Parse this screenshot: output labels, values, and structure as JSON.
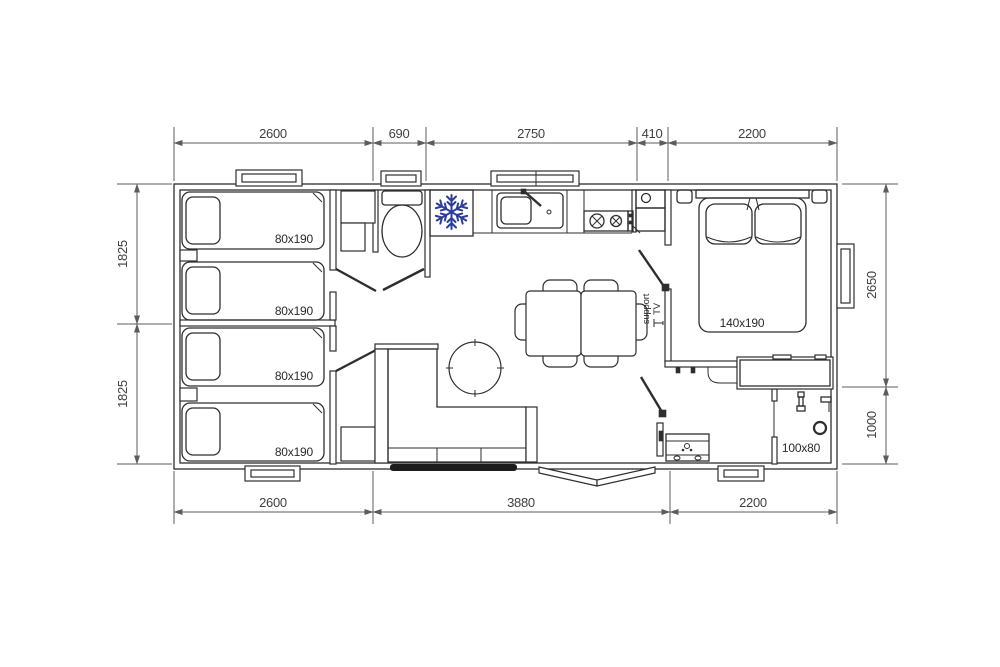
{
  "document": {
    "type": "floor-plan",
    "subject": "mobile home layout with three bedrooms, bathroom, kitchen and living room"
  },
  "colors": {
    "background": "#ffffff",
    "line": "#2e2e2e",
    "dimension_line": "#5c5c5c",
    "snowflake": "#2e3d9b",
    "dark_window": "#1c1c1c"
  },
  "dimensions": {
    "top": [
      "2600",
      "690",
      "2750",
      "410",
      "2200"
    ],
    "bottom": [
      "2600",
      "3880",
      "2200"
    ],
    "left": [
      "1825",
      "1825"
    ],
    "right": [
      "2650",
      "1000"
    ]
  },
  "labels": {
    "bed1": "80x190",
    "bed2": "80x190",
    "bed3": "80x190",
    "bed4": "80x190",
    "master_bed": "140x190",
    "shower": "100x80",
    "tv_line1": "support",
    "tv_line2": "TV"
  },
  "icons": {
    "fridge": "snowflake-icon",
    "toilet": "toilet-icon",
    "shower": "shower-head-icon"
  }
}
